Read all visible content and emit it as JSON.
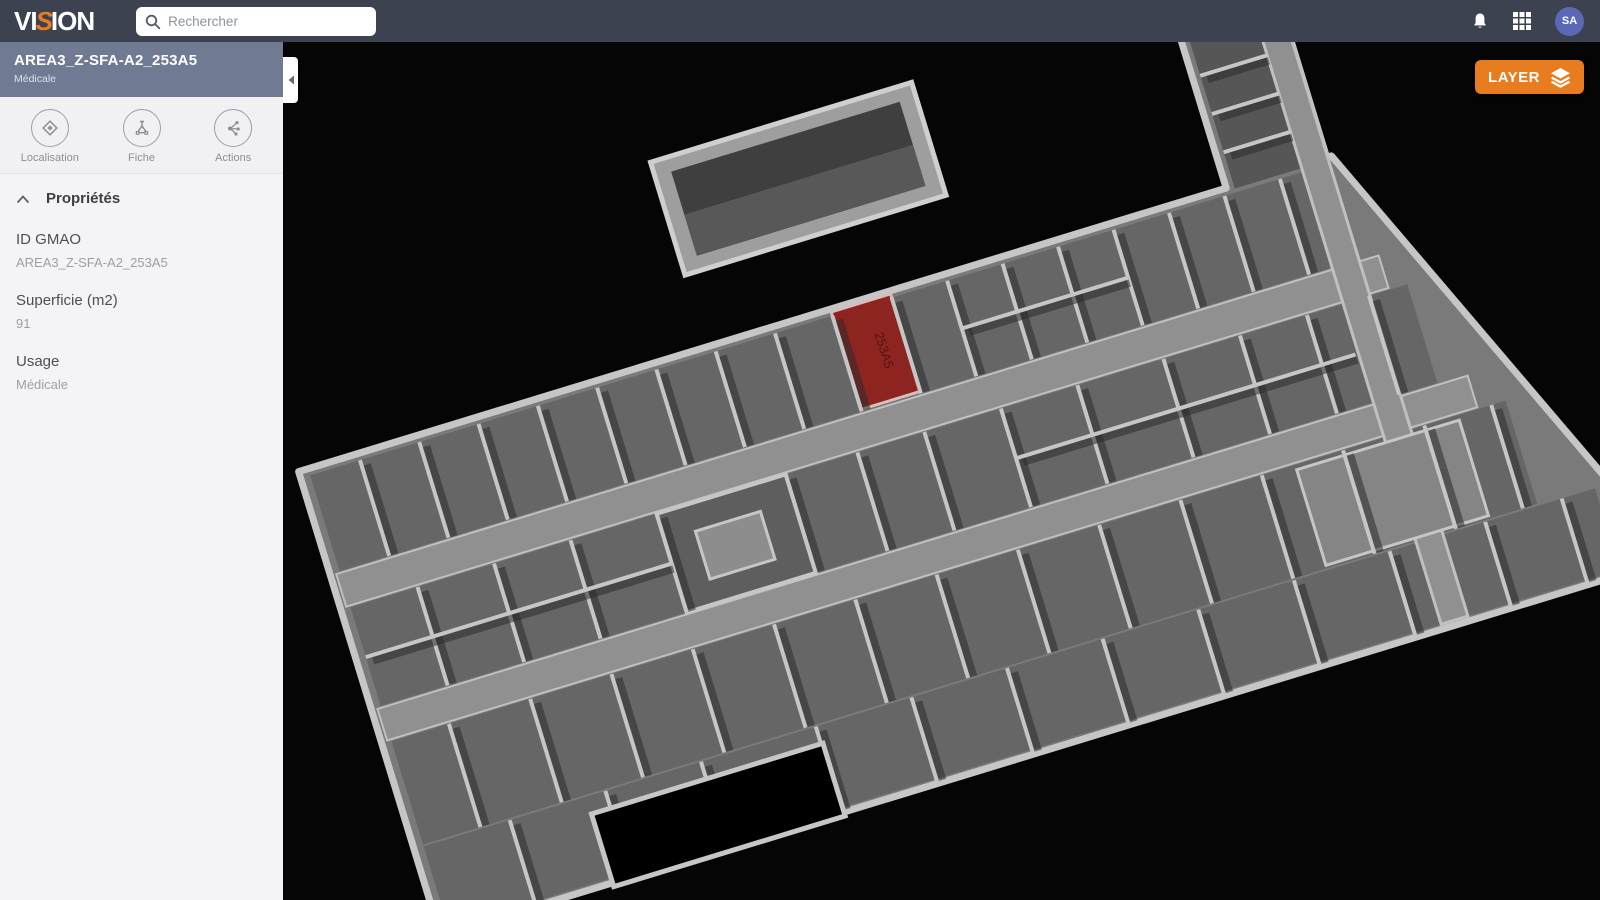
{
  "topbar": {
    "logo": {
      "prefix": "VI",
      "accent": "S",
      "suffix": "ION"
    },
    "search": {
      "placeholder": "Rechercher"
    },
    "avatar": "SA"
  },
  "sidebar": {
    "header": {
      "title": "AREA3_Z-SFA-A2_253A5",
      "subtitle": "Médicale"
    },
    "actions": [
      {
        "label": "Localisation"
      },
      {
        "label": "Fiche"
      },
      {
        "label": "Actions"
      }
    ],
    "properties": {
      "title": "Propriétés",
      "items": [
        {
          "label": "ID GMAO",
          "value": "AREA3_Z-SFA-A2_253A5"
        },
        {
          "label": "Superficie (m2)",
          "value": "91"
        },
        {
          "label": "Usage",
          "value": "Médicale"
        }
      ]
    }
  },
  "viewer": {
    "layer_button_label": "LAYER",
    "selected_room_label": "253A5",
    "colors": {
      "accent_orange": "#e87c1e",
      "selected_room": "#8e2420",
      "selected_room_edge": "#d8bdbd",
      "avatar_bg": "#5a68b5",
      "topbar_bg": "#3c4250",
      "sidebar_header_bg": "#707b93",
      "canvas_bg": "#050505",
      "wall_light": "#c6c6c6",
      "room_dark": "#666666",
      "floor_mid": "#7a7a7a",
      "corridor": "#909090",
      "shadow": "#2c2c2c"
    }
  }
}
